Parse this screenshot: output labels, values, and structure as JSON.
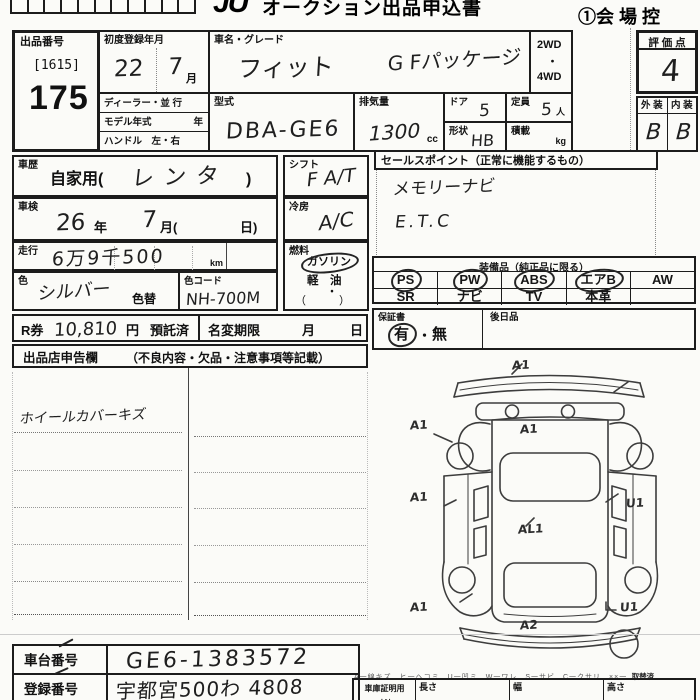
{
  "header": {
    "logo": "JU",
    "title": "オークション出品申込書",
    "copy": "①会 場 控"
  },
  "lot": {
    "label": "出品番号",
    "bracket": "[1615]",
    "number": "175"
  },
  "firstreg": {
    "label": "初度登録年月",
    "year": "22",
    "month": "7",
    "month_unit": "月"
  },
  "vehicle": {
    "name_label": "車名・グレード",
    "name": "フィット",
    "grade": "G Fパッケージ",
    "wd2": "2WD",
    "dot": "・",
    "wd4": "4WD",
    "dealer_label": "ディーラー・並 行",
    "modelyear_label": "モデル年式",
    "modelyear_unit": "年",
    "handle_label": "ハンドル　左・右",
    "type_label": "型式",
    "type": "DBA-GE6",
    "disp_label": "排気量",
    "disp": "1300",
    "disp_unit": "cc",
    "door_label": "ドア",
    "door": "5",
    "cap_label": "定員",
    "cap": "5",
    "cap_unit": "人",
    "shape_label": "形状",
    "shape": "HB",
    "load_label": "積載",
    "load_unit": "kg"
  },
  "rating": {
    "label": "評 価 点",
    "value": "4",
    "ext_label": "外 装",
    "int_label": "内 装",
    "ext": "B",
    "int": "B"
  },
  "history": {
    "label": "車歴",
    "printed_open": "自家用(",
    "written": "レンタ",
    "printed_close": ")"
  },
  "inspection": {
    "label": "車検",
    "year": "26",
    "year_unit": "年",
    "month": "7",
    "month_unit": "月(",
    "day_unit": "日)"
  },
  "mileage": {
    "label": "走行",
    "value": "6万9千500",
    "unit": "km"
  },
  "color": {
    "label": "色",
    "value": "シルバー",
    "change_label": "色替",
    "code_label": "色コード",
    "code": "NH-700M"
  },
  "shift": {
    "label": "シフト",
    "value": "F A/T"
  },
  "ac": {
    "label": "冷房",
    "value": "A/C"
  },
  "fuel": {
    "label": "燃料",
    "gasoline": "ガソリン",
    "gasoline_circled": true,
    "diesel": "軽　油",
    "dot": "・",
    "paren": "（　　　）"
  },
  "rken": {
    "label": "R券",
    "value": "10,810",
    "unit": "円",
    "deposit": "預託済"
  },
  "rename": {
    "label": "名変期限",
    "month": "月",
    "day": "日"
  },
  "declaration": {
    "label": "出品店申告欄",
    "note": "（不良内容・欠品・注意事項等記載）",
    "entry": "ホイールカバーキズ"
  },
  "sales": {
    "label": "セールスポイント（正常に機能するもの）",
    "lines": [
      "メモリーナビ",
      "E.T.C"
    ]
  },
  "equipment": {
    "label": "装備品（純正品に限る）",
    "row1": [
      {
        "t": "PS",
        "c": true
      },
      {
        "t": "PW",
        "c": true
      },
      {
        "t": "ABS",
        "c": true
      },
      {
        "t": "エアB",
        "c": true
      },
      {
        "t": "AW",
        "c": false
      }
    ],
    "row2": [
      {
        "t": "SR",
        "c": false
      },
      {
        "t": "ナビ",
        "c": false
      },
      {
        "t": "TV",
        "c": false
      },
      {
        "t": "本革",
        "c": false
      },
      {
        "t": "",
        "c": false
      }
    ]
  },
  "warranty": {
    "label": "保証書",
    "yes": "有",
    "yes_circled": true,
    "sep": "・",
    "no": "無",
    "later": "後日品"
  },
  "diagram": {
    "marks": [
      {
        "t": "A1"
      },
      {
        "t": "A1"
      },
      {
        "t": "A1"
      },
      {
        "t": "A1"
      },
      {
        "t": "U1"
      },
      {
        "t": "AL1"
      },
      {
        "t": "A1"
      },
      {
        "t": "U1"
      },
      {
        "t": "A2"
      }
    ],
    "legend": "A一線キズ　ヒ一ヘコミ　U一凹ミ　W一ワレ　S一サビ　C一クサリ　××一",
    "legend_end": "取替済"
  },
  "garage": {
    "label": "車庫証明用",
    "label2": "寸法",
    "len": "長さ",
    "wid": "幅",
    "hei": "高さ",
    "unit": "cm"
  },
  "ids": {
    "vin_label": "車台番号",
    "vin": "GE6-1383572",
    "reg_label": "登録番号",
    "reg": "宇都宮500わ 4808"
  }
}
